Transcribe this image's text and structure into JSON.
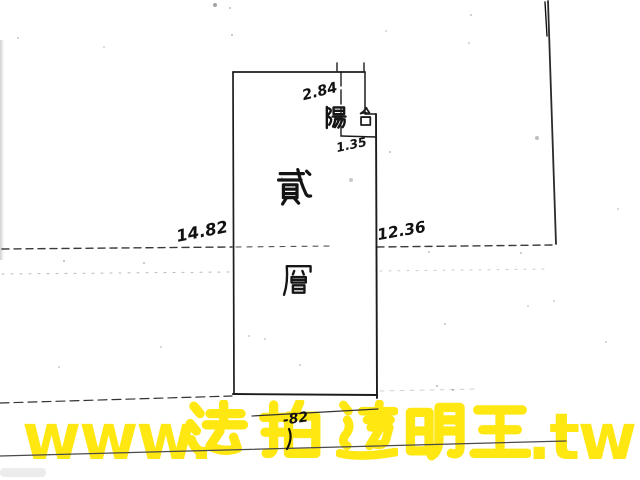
{
  "page": {
    "background_color": "#ffffff",
    "ink_color": "#222222"
  },
  "plan": {
    "floor_label": "貳層",
    "floor_char_top": "貳",
    "floor_char_bottom": "層",
    "balcony_label": "陽台",
    "dimensions": {
      "balcony_width": "2.84",
      "balcony_depth": "1.35",
      "side_left": "14.82",
      "side_right": "12.36",
      "bottom": "-82"
    }
  },
  "watermark": {
    "full_text": "www.法拍透明王.tw",
    "prefix": "www.",
    "cjk": "法拍透明王",
    "suffix": ".tw",
    "color": "#ffe712"
  }
}
